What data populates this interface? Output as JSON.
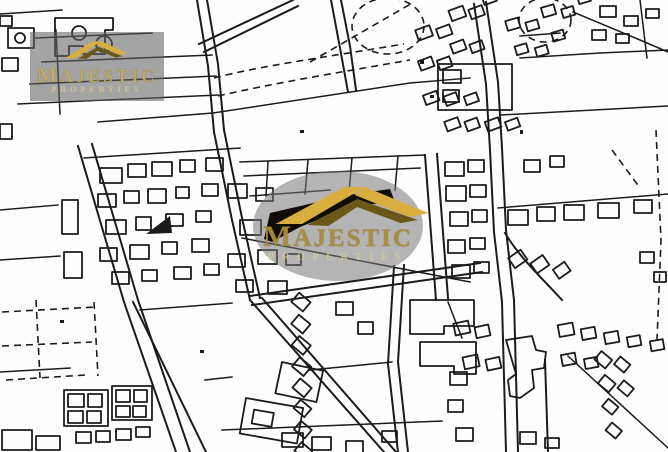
{
  "map": {
    "alt_text": "Black and white cadastral street map with a land plot highlighted in black at the center"
  },
  "watermarks": {
    "top_left": {
      "brand": "MAJESTIC",
      "tagline": "PROPERTIES",
      "logo": "roof-swoosh-icon"
    },
    "center": {
      "brand": "MAJESTIC",
      "tagline": "PROPERTIES",
      "logo": "roof-swoosh-icon"
    }
  },
  "colors": {
    "map_line": "#1b1b1b",
    "map_background": "#fefefe",
    "plot_fill": "#0f0d06",
    "logo_gold": "#d8ae3f",
    "logo_gold_dark": "#6b5718",
    "brand_text": "#a98c3a",
    "tagline_text": "#d6c894",
    "watermark_gray": "rgba(118,118,118,0.55)"
  }
}
